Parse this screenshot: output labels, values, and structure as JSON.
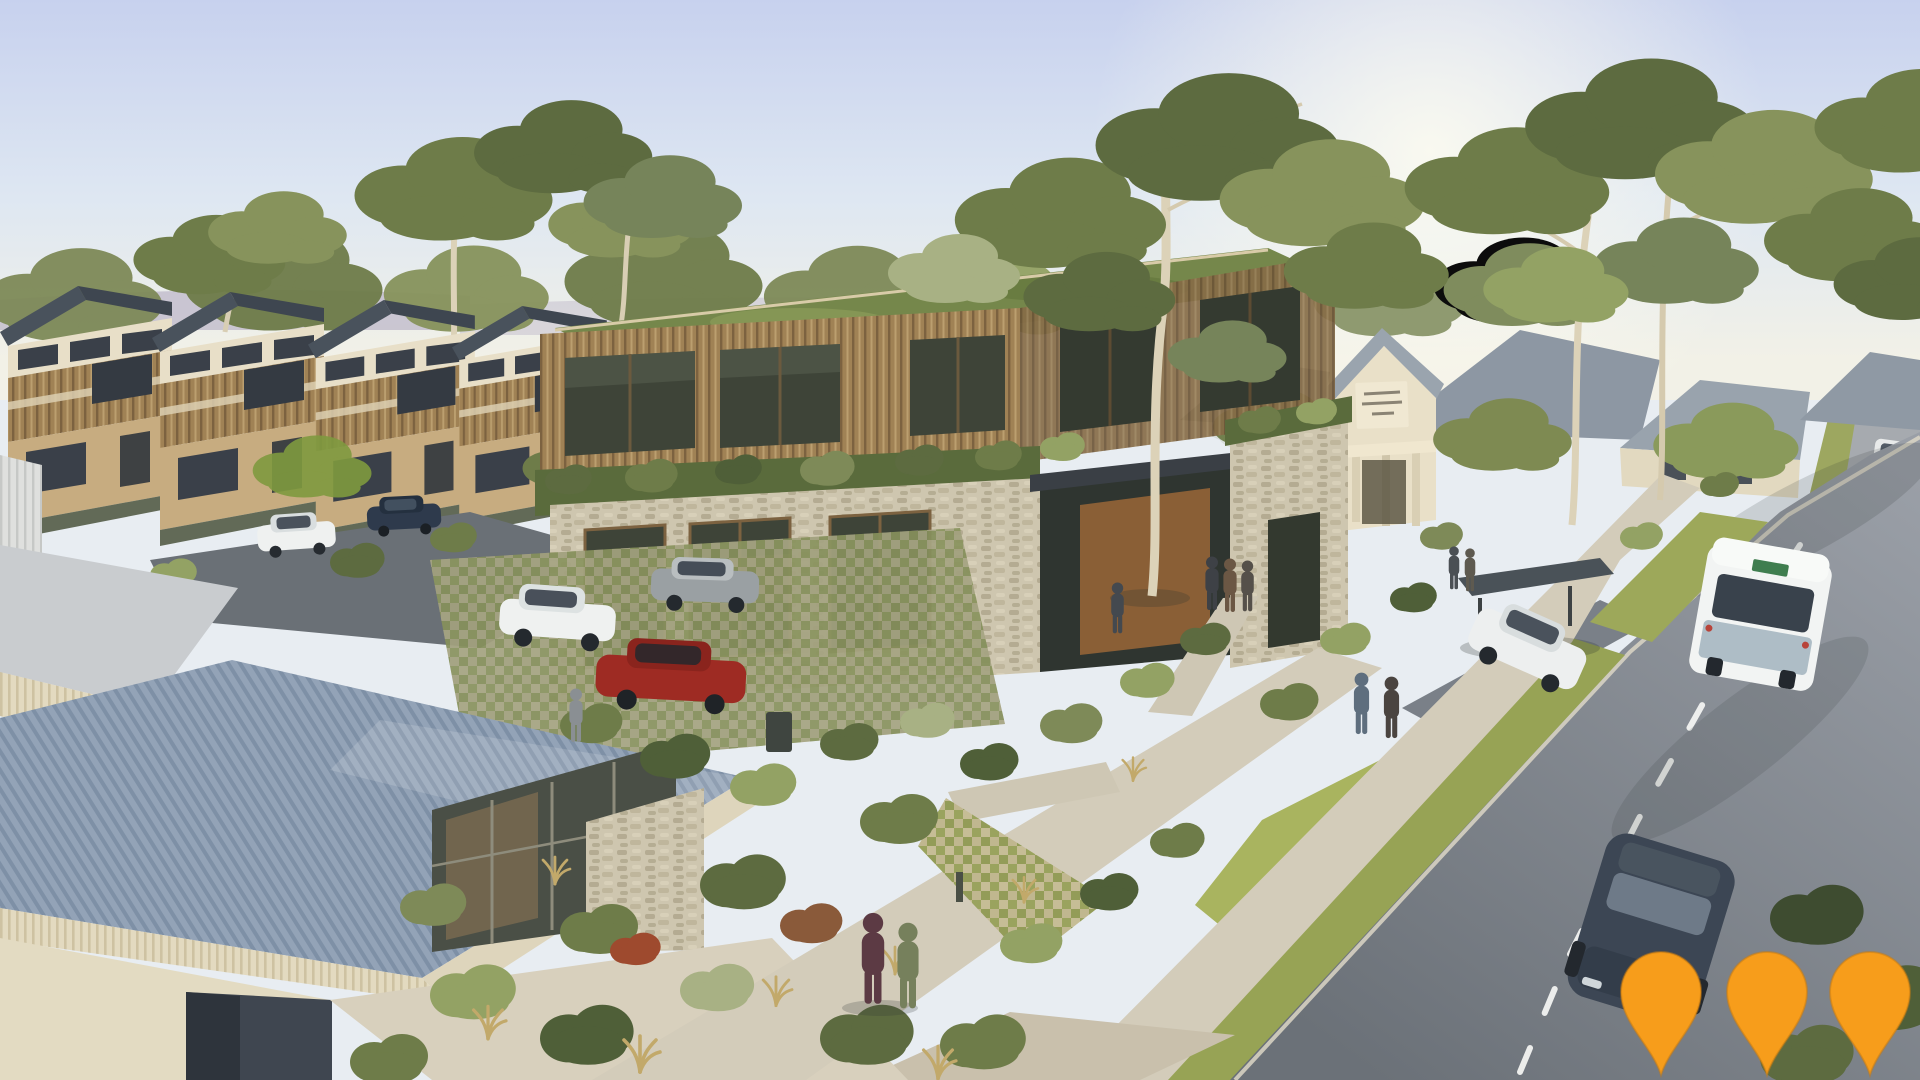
{
  "scene": {
    "setting": "aerial architectural render of a suburban community precinct at golden hour",
    "elements": [
      "townhouse-row",
      "community-building-with-green-roof",
      "stone-clad-ground-floor",
      "community-hall",
      "suburban-houses",
      "main-road",
      "bus",
      "bus-shelter",
      "parked-cars",
      "pedestrians",
      "eucalyptus-trees",
      "landscaped-gardens",
      "footpaths",
      "grass-verges",
      "foreground-metal-roof-building",
      "map-pins"
    ]
  },
  "markers": {
    "shape": "map-pin",
    "count": 3,
    "color": "#F79D1B",
    "outline": "#C97C10"
  },
  "vehicles": {
    "bus": "white transit bus seen from rear",
    "cars": [
      "white SUV",
      "red hatchback",
      "grey hatchback",
      "white parked car at bus bay",
      "dark grey car on road",
      "white car at townhouses",
      "dark blue car at townhouses",
      "distant white car"
    ]
  },
  "people_count": 11,
  "palette": {
    "sky_top": "#C7D1EE",
    "sky_mid": "#DEE7F2",
    "sky_horizon": "#F2F1E7",
    "sun_glow": "#FFFDF0",
    "hills": "#B7AFC4",
    "foliage_dark": "#4F5F38",
    "foliage_mid": "#6E7C49",
    "foliage_light": "#93A264",
    "foliage_sage": "#A8B184",
    "eucalyptus_trunk": "#DCD2B8",
    "timber_light": "#C7AC80",
    "timber_mid": "#A08255",
    "timber_dark": "#7C6240",
    "glass_dark": "#3A4049",
    "glass_green": "#3E4438",
    "stone": "#CEC6AF",
    "stone_speckle": "#B4AB92",
    "green_roof": "#75874B",
    "green_roof_dark": "#5A6B3C",
    "roof_dark": "#49525C",
    "roof_blue_a": "#93A3B7",
    "roof_blue_b": "#7E90A6",
    "fascia_cream": "#E3DAC0",
    "wall_cream": "#E6DEC6",
    "road_far": "#9A9FA7",
    "road_near": "#6B7178",
    "upper_road": "#A6AAAF",
    "lane_marking": "#F2F3F1",
    "grass_verge": "#97A355",
    "grass_verge_light": "#A9B45F",
    "path_concrete": "#D3CCBA",
    "asphalt_drive": "#6A7076",
    "kerb": "#E0DACA",
    "car_white": "#EFF1F0",
    "car_red": "#9E2B23",
    "car_grey": "#9AA0A3",
    "car_dark": "#3C4654",
    "bus_white": "#F2F4F3",
    "bus_skirt": "#AEBDC6"
  }
}
